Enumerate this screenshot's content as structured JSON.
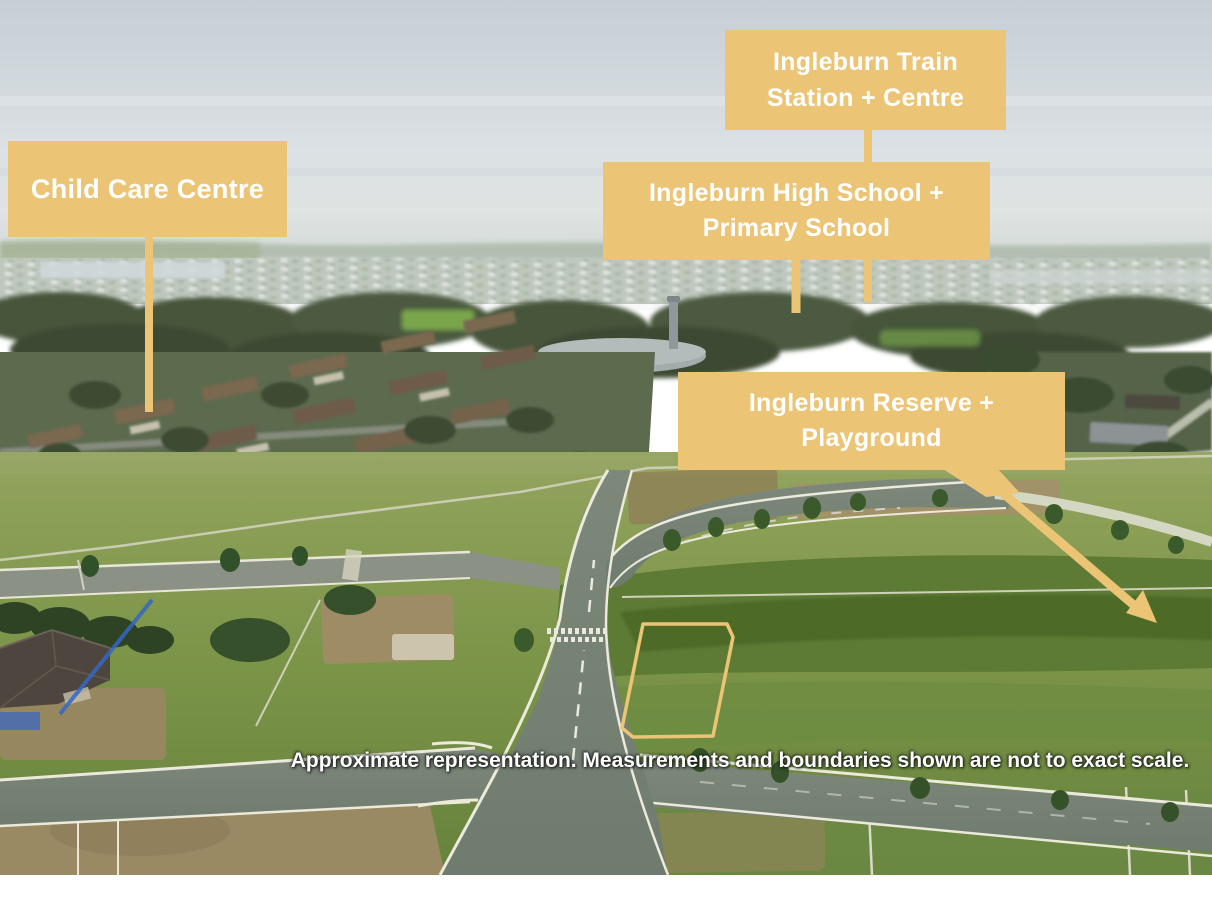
{
  "annotations": {
    "train_station": {
      "label": "Ingleburn Train\nStation + Centre"
    },
    "child_care": {
      "label": "Child Care Centre"
    },
    "school": {
      "label": "Ingleburn High School +\nPrimary School"
    },
    "reserve": {
      "label": "Ingleburn Reserve +\nPlayground"
    }
  },
  "disclaimer": "Approximate representation. Measurements and boundaries shown are not to exact scale.",
  "colors": {
    "callout_bg": "#ecc475",
    "callout_text": "#ffffff",
    "lot_outline": "#eec97e",
    "disclaimer_text": "#ffffff"
  },
  "lot": {
    "points": "643,624 727,624 733,637 713,736 633,737 622,728"
  }
}
